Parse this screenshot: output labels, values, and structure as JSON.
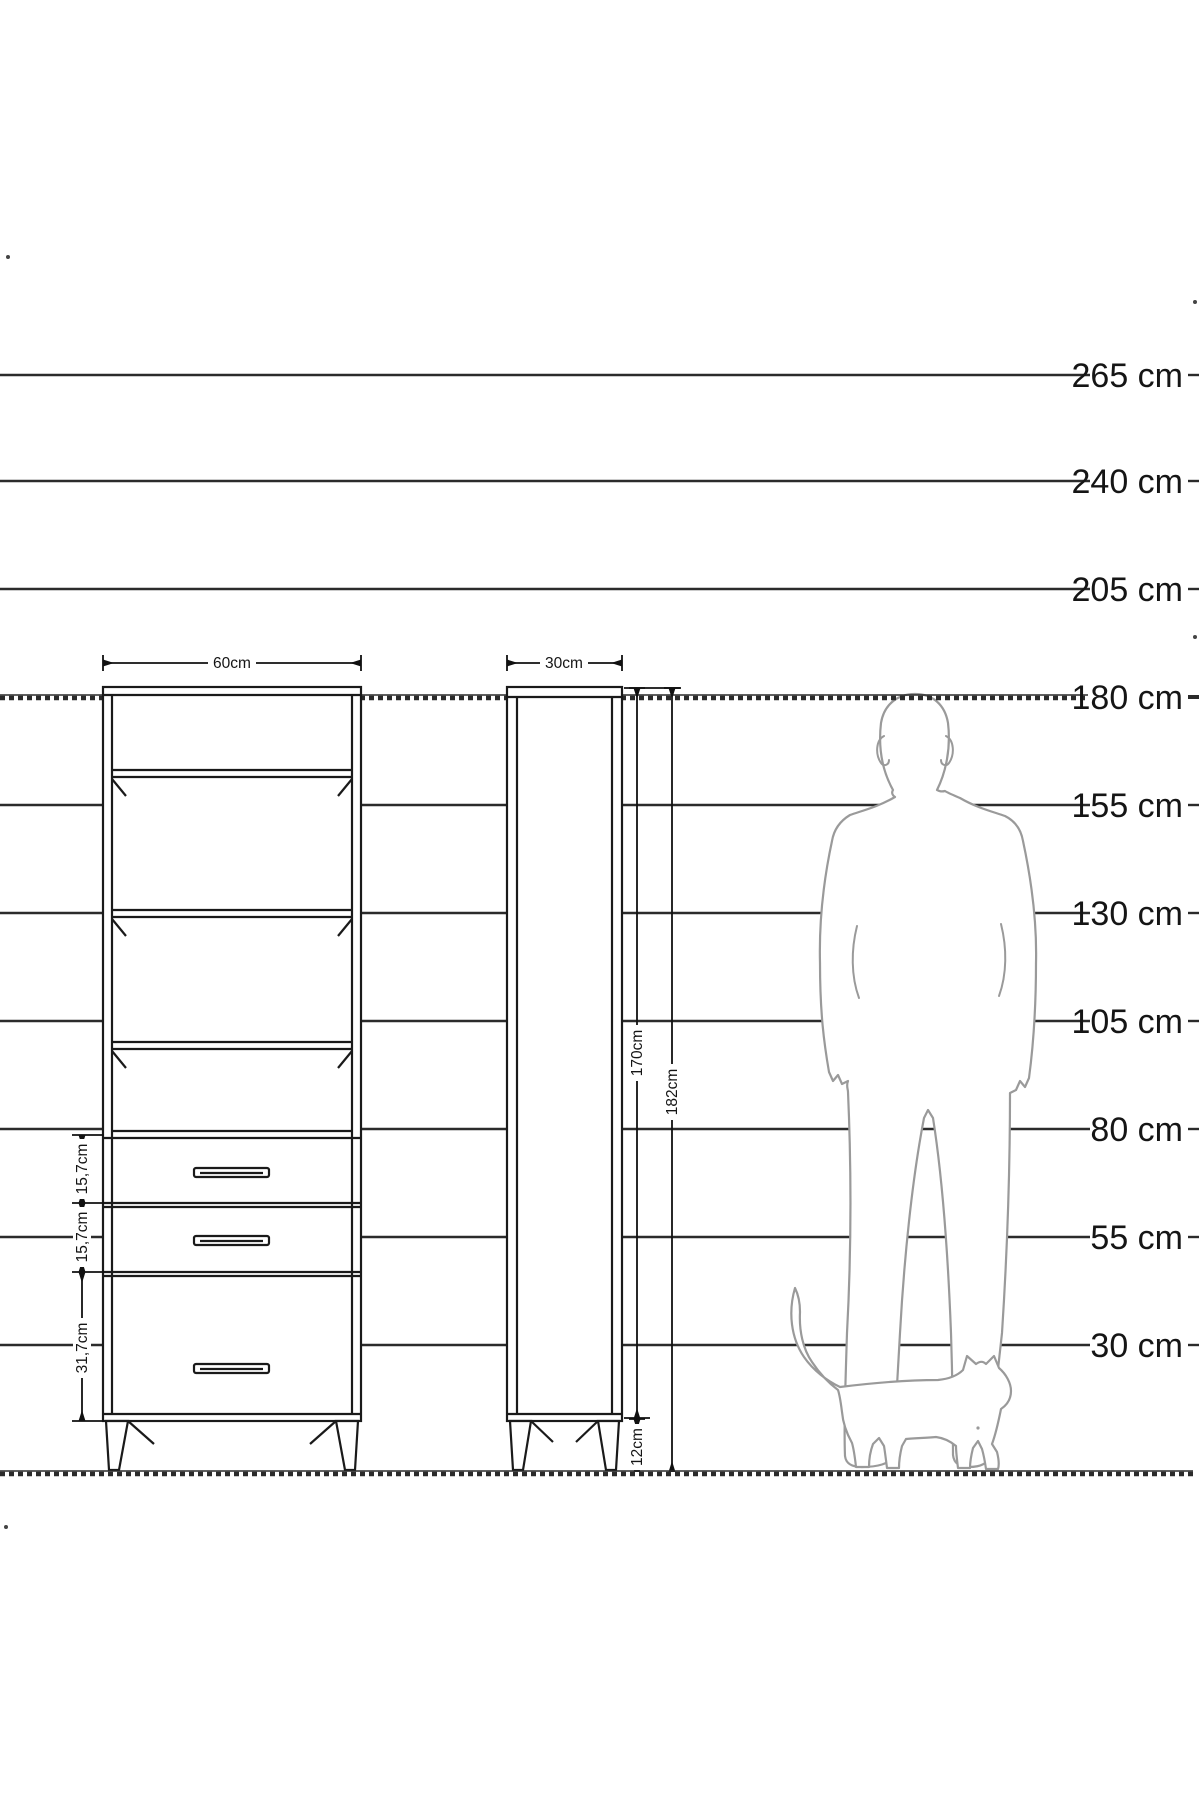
{
  "colors": {
    "background": "#ffffff",
    "drawing_line": "#1a1a1a",
    "ruler_line": "#2b2b2b",
    "figure_outline": "#9a9a9a",
    "label_text": "#151515"
  },
  "ruler": {
    "unit": "cm",
    "line_end_x": 1090,
    "label_x": 1183,
    "ground_y": 1473,
    "lines": [
      {
        "label": "265 cm",
        "y": 375,
        "style": "solid"
      },
      {
        "label": "240 cm",
        "y": 481,
        "style": "solid"
      },
      {
        "label": "205 cm",
        "y": 589,
        "style": "solid"
      },
      {
        "label": "180 cm",
        "y": 697,
        "style": "hatched"
      },
      {
        "label": "155 cm",
        "y": 805,
        "style": "solid"
      },
      {
        "label": "130 cm",
        "y": 913,
        "style": "solid"
      },
      {
        "label": "105 cm",
        "y": 1021,
        "style": "solid"
      },
      {
        "label": "80 cm",
        "y": 1129,
        "style": "solid"
      },
      {
        "label": "55 cm",
        "y": 1237,
        "style": "solid"
      },
      {
        "label": "30 cm",
        "y": 1345,
        "style": "solid"
      }
    ]
  },
  "dimensions": {
    "front_width": "60cm",
    "side_depth": "30cm",
    "carcass_height": "170cm",
    "total_height": "182cm",
    "leg_height": "12cm",
    "drawer_top": "15,7cm",
    "drawer_middle": "15,7cm",
    "drawer_bottom": "31,7cm"
  },
  "furniture": {
    "front_view_shelves": 4,
    "front_view_drawers": 3,
    "views": [
      "front",
      "side"
    ]
  }
}
